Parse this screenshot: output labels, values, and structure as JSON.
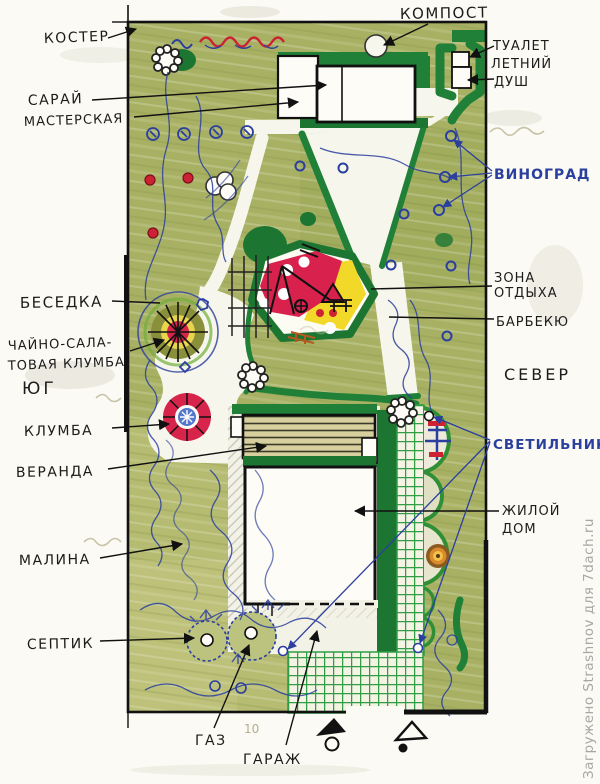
{
  "plan": {
    "labels": {
      "campfire": "КОСТЕР",
      "shed_line1": "САРАЙ",
      "shed_line2": "МАСТЕРСКАЯ",
      "compost": "КОМПОСТ",
      "toilet": "ТУАЛЕТ",
      "shower_line1": "ЛЕТНИЙ",
      "shower_line2": "ДУШ",
      "grapes": "ВИНОГРАД",
      "rest_line1": "ЗОНА",
      "rest_line2": "ОТДЫХА",
      "barbecue": "БАРБЕКЮ",
      "north": "СЕВЕР",
      "south": "ЮГ",
      "gazebo": "БЕСЕДКА",
      "tea_bed_line1": "ЧАЙНО-САЛА-",
      "tea_bed_line2": "ТОВАЯ КЛУМБА",
      "flowerbed": "КЛУМБА",
      "veranda": "ВЕРАНДА",
      "raspberry": "МАЛИНА",
      "septic": "СЕПТИК",
      "gas": "ГАЗ",
      "garage": "ГАРАЖ",
      "house_line1": "ЖИЛОЙ",
      "house_line2": "ДОМ",
      "lamp": "СВЕТИЛЬНИК",
      "pencil_note": "10"
    },
    "watermark": "Загружено Strashnov для 7dach.ru",
    "colors": {
      "paper": "#fbfaf4",
      "lawn": "#a8b163",
      "hedge": "#208038",
      "grid_green": "#2f9e44",
      "ink_blue": "#2b3f9e",
      "label_black": "#1c1c1c",
      "playground_red": "#d8214d",
      "playground_yellow": "#f2d829",
      "watermark_gray": "#a7a7a7"
    }
  }
}
